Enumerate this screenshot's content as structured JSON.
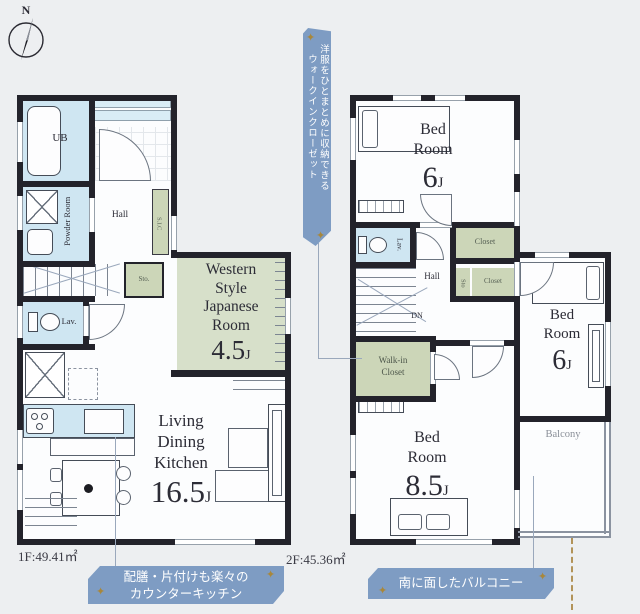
{
  "page": {
    "background": "#edeff1"
  },
  "compass": {
    "north_label": "N"
  },
  "floor1": {
    "area_label": "1F:49.41㎡",
    "ub": "UB",
    "powder": "Powder Room",
    "hall": "Hall",
    "lav": "Lav.",
    "sic": "S.I.C",
    "sto": "Sto.",
    "japanese_room": {
      "l1": "Western",
      "l2": "Style",
      "l3": "Japanese",
      "l4": "Room",
      "size": "4.5",
      "unit": "J"
    },
    "ldk": {
      "l1": "Living",
      "l2": "Dining",
      "l3": "Kitchen",
      "size": "16.5",
      "unit": "J"
    }
  },
  "floor2": {
    "area_label": "2F:45.36㎡",
    "bed1": {
      "l1": "Bed",
      "l2": "Room",
      "size": "6",
      "unit": "J"
    },
    "bed2": {
      "l1": "Bed",
      "l2": "Room",
      "size": "8.5",
      "unit": "J"
    },
    "bed3": {
      "l1": "Bed",
      "l2": "Room",
      "size": "6",
      "unit": "J"
    },
    "lav": "Lav.",
    "closet_top": "Closet",
    "closet_small": "Closet",
    "sto": "Sto",
    "hall": "Hall",
    "dn": "DN",
    "wic": {
      "l1": "Walk-in",
      "l2": "Closet"
    },
    "balcony": "Balcony"
  },
  "annotations": {
    "walk_in_closet": {
      "line1": "洋服をひとまとめに収納できる",
      "line2": "ウォークインクローゼット"
    },
    "counter_kitchen": {
      "line1": "配膳・片付けも楽々の",
      "line2": "カウンターキッチン"
    },
    "south_balcony": "南に面したバルコニー"
  },
  "icons": {
    "star": "✦"
  },
  "colors": {
    "wall": "#23232b",
    "wet_area": "#cfe6f2",
    "tatami": "#d7e0ca",
    "closet": "#ccd6b8",
    "banner": "#7e9cc3",
    "gold": "#a8873b"
  }
}
